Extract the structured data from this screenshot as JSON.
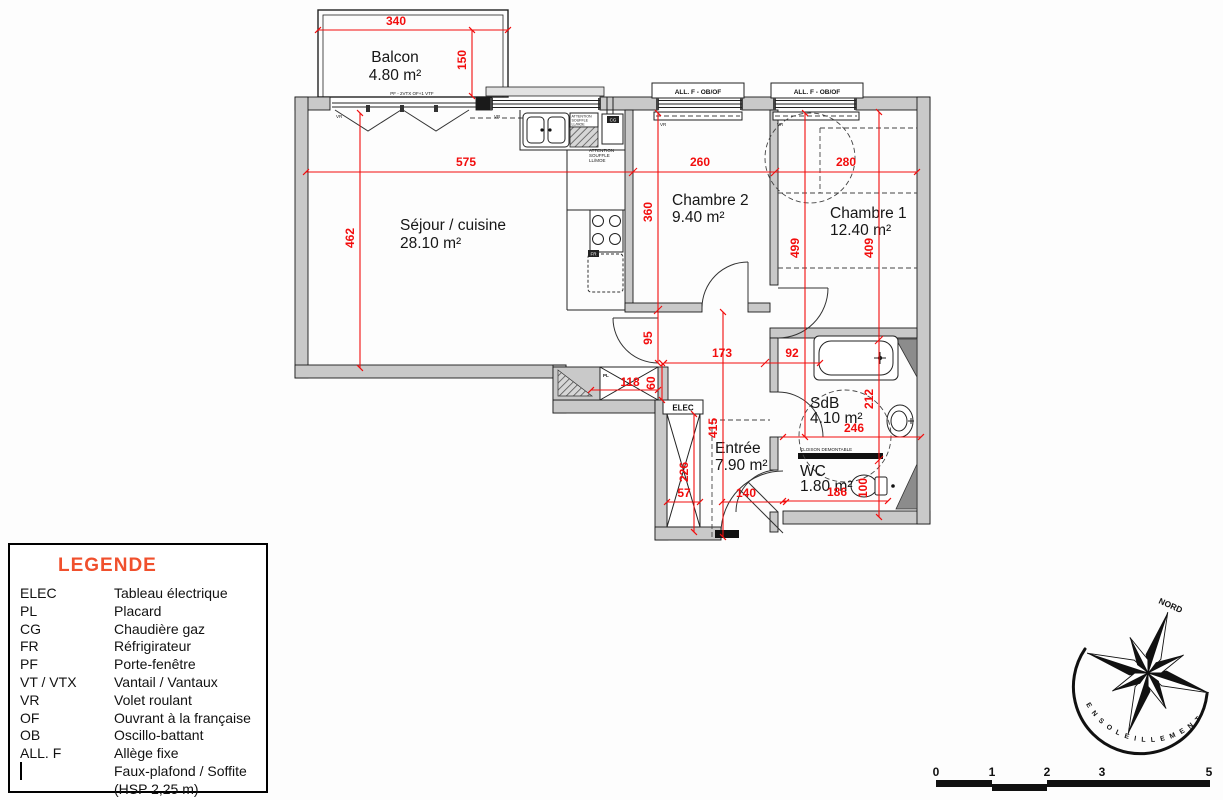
{
  "plan": {
    "balcony": {
      "name": "Balcon",
      "area": "4.80 m²"
    },
    "rooms": [
      {
        "name": "Séjour / cuisine",
        "area": "28.10 m²"
      },
      {
        "name": "Chambre 2",
        "area": "9.40 m²"
      },
      {
        "name": "Chambre 1",
        "area": "12.40 m²"
      },
      {
        "name": "SdB",
        "area": "4.10 m²"
      },
      {
        "name": "WC",
        "area": "1.80 m²"
      },
      {
        "name": "Entrée",
        "area": "7.90 m²"
      }
    ],
    "dims": {
      "balcony_w": "340",
      "balcony_d": "150",
      "sejour_w": "575",
      "sejour_h": "462",
      "ch2_w": "260",
      "ch2_h": "360",
      "ch1_w": "280",
      "ch1_h_left": "499",
      "ch1_h_right": "409",
      "opening_95": "95",
      "hall_a": "173",
      "hall_b": "92",
      "placard_w": "118",
      "placard_d": "60",
      "entree_h": "415",
      "elec_h": "226",
      "elec_w": "57",
      "entree_w": "140",
      "sdb_h": "212",
      "sdb_w": "246",
      "wc_w": "186",
      "wc_h": "100"
    },
    "annotations": {
      "pf_note": "PF - 2VTX OF+1 VTF",
      "window_label": "ALL. F - OB/OF",
      "vr": "VR",
      "elec": "ELEC",
      "pl": "PL",
      "cg": "CG",
      "fr": "FR",
      "cloison": "CLOISON DEMONTABLE",
      "attention_1": "ATTENTION",
      "attention_2": "SOUFFLE",
      "attention_3": "LL/MOE"
    }
  },
  "legend": {
    "title": "LEGENDE",
    "entries": [
      {
        "abbr": "ELEC",
        "label": "Tableau électrique"
      },
      {
        "abbr": "PL",
        "label": "Placard"
      },
      {
        "abbr": "CG",
        "label": "Chaudière gaz"
      },
      {
        "abbr": "FR",
        "label": "Réfrigirateur"
      },
      {
        "abbr": "PF",
        "label": "Porte-fenêtre"
      },
      {
        "abbr": "VT / VTX",
        "label": "Vantail / Vantaux"
      },
      {
        "abbr": "VR",
        "label": "Volet roulant"
      },
      {
        "abbr": "OF",
        "label": "Ouvrant à la française"
      },
      {
        "abbr": "OB",
        "label": "Oscillo-battant"
      },
      {
        "abbr": "ALL. F",
        "label": "Allège fixe"
      },
      {
        "abbr": "",
        "label": "Faux-plafond / Soffite (HSP 2,25 m)"
      }
    ]
  },
  "compass": {
    "north": "NORD",
    "sun_label": "ENSOLEILLEMENT"
  },
  "scalebar": {
    "labels": [
      "0",
      "1",
      "2",
      "3",
      "5"
    ]
  },
  "colors": {
    "dim_red": "#f20d0d",
    "legend_title": "#f0502d",
    "wall_fill": "#c9c9c9"
  }
}
